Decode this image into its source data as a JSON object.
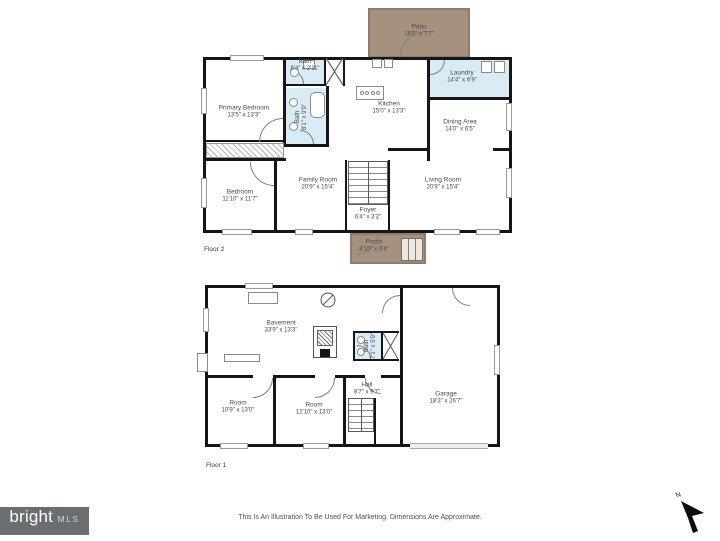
{
  "page": {
    "disclaimer": "This Is An Illustration To Be Used For Marketing. Dimensions Are Approximate.",
    "north_label": "N",
    "logo": {
      "brand": "bright",
      "asterisk": "*",
      "suffix": "MLS"
    }
  },
  "colors": {
    "wall": "#161616",
    "wet_room_fill": "#d9ecf6",
    "outdoor_fill": "#a5917d",
    "logo_background": "#6a6e71",
    "logo_asterisk": "#e05a2b"
  },
  "floor2": {
    "label": "Floor 2",
    "rooms": {
      "patio": {
        "name": "Patio",
        "dims": "16'5\" x 7'7\""
      },
      "primary_bedroom": {
        "name": "Primary Bedroom",
        "dims": "13'5\" x 13'3\""
      },
      "bath_top": {
        "name": "Bath",
        "dims": "8'4\" x 2'11\""
      },
      "bath_main": {
        "name": "Bath",
        "dims": "8'1\" x 9'0\""
      },
      "kitchen": {
        "name": "Kitchen",
        "dims": "15'0\" x 13'3\""
      },
      "laundry": {
        "name": "Laundry",
        "dims": "14'4\" x 6'9\""
      },
      "dining": {
        "name": "Dining Area",
        "dims": "14'0\" x 6'5\""
      },
      "bedroom": {
        "name": "Bedroom",
        "dims": "11'10\" x 11'7\""
      },
      "family": {
        "name": "Family Room",
        "dims": "20'9\" x 15'4\""
      },
      "living": {
        "name": "Living Room",
        "dims": "20'9\" x 15'4\""
      },
      "foyer": {
        "name": "Foyer",
        "dims": "6'4\" x 3'2\""
      },
      "porch": {
        "name": "Porch",
        "dims": "8'10\" x 6'4\""
      }
    }
  },
  "floor1": {
    "label": "Floor 1",
    "rooms": {
      "basement": {
        "name": "Basement",
        "dims": "33'9\" x 13'3\""
      },
      "bath": {
        "name": "Bath",
        "dims": "7'1\" x 5'9\""
      },
      "room_left": {
        "name": "Room",
        "dims": "10'9\" x 13'0\""
      },
      "room_center": {
        "name": "Room",
        "dims": "12'10\" x 13'0\""
      },
      "hall": {
        "name": "Hall",
        "dims": "8'7\" x 9'7\""
      },
      "garage": {
        "name": "Garage",
        "dims": "18'3\" x 26'7\""
      }
    }
  }
}
